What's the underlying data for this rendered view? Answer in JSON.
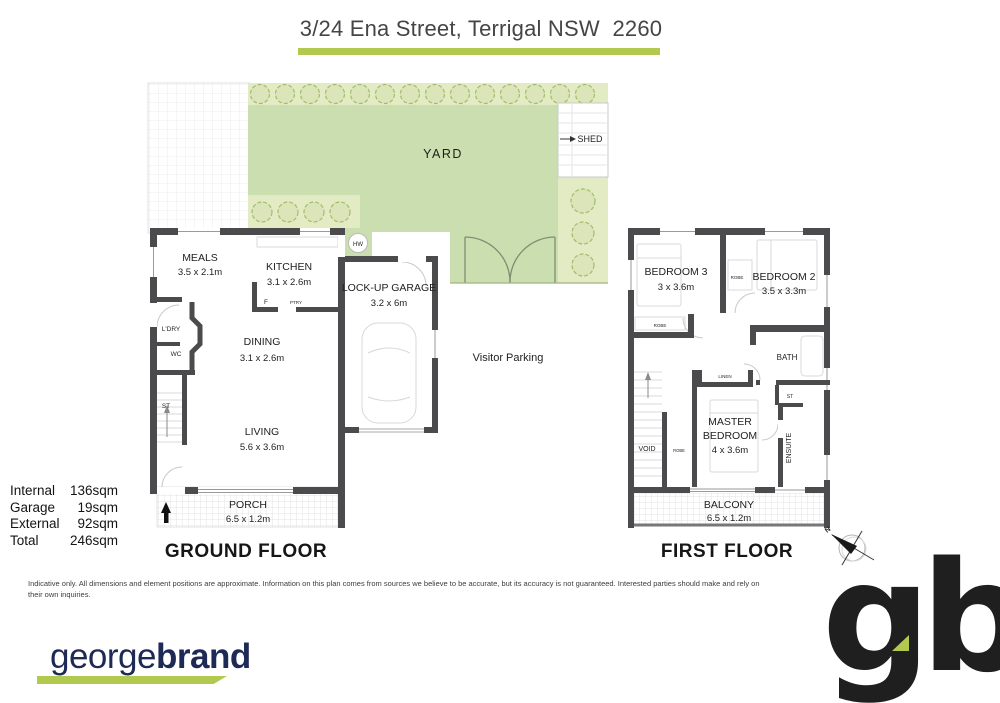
{
  "header": {
    "title": "3/24 Ena Street, Terrigal NSW  2260"
  },
  "yard": {
    "label": "YARD",
    "shed_label": "SHED",
    "hw_label": "HW"
  },
  "visitor_parking": "Visitor Parking",
  "ground": {
    "floor_label": "GROUND FLOOR",
    "meals": {
      "name": "MEALS",
      "dims": "3.5 x 2.1m"
    },
    "kitchen": {
      "name": "KITCHEN",
      "dims": "3.1 x 2.6m"
    },
    "garage": {
      "name": "LOCK-UP GARAGE",
      "dims": "3.2 x 6m"
    },
    "dining": {
      "name": "DINING",
      "dims": "3.1 x 2.6m"
    },
    "living": {
      "name": "LIVING",
      "dims": "5.6 x 3.6m"
    },
    "porch": {
      "name": "PORCH",
      "dims": "6.5 x 1.2m"
    },
    "laundry": "L'DRY",
    "wc": "WC",
    "stair": "ST",
    "fridge": "F",
    "pantry": "PTRY"
  },
  "first": {
    "floor_label": "FIRST FLOOR",
    "bed3": {
      "name": "BEDROOM 3",
      "dims": "3 x 3.6m"
    },
    "bed2": {
      "name": "BEDROOM 2",
      "dims": "3.5 x 3.3m"
    },
    "master": {
      "line1": "MASTER",
      "line2": "BEDROOM",
      "dims": "4 x 3.6m"
    },
    "balcony": {
      "name": "BALCONY",
      "dims": "6.5 x 1.2m"
    },
    "bath": "BATH",
    "ensuite": "ENSUITE",
    "linen": "LINEN",
    "void": "VOID",
    "robe": "ROBE",
    "st": "ST",
    "compass_n": "N"
  },
  "areas": {
    "rows": [
      {
        "label": "Internal",
        "value": "136sqm"
      },
      {
        "label": "Garage",
        "value": "19sqm"
      },
      {
        "label": "External",
        "value": "92sqm"
      },
      {
        "label": "Total",
        "value": "246sqm"
      }
    ]
  },
  "disclaimer": "Indicative only. All dimensions and element positions are approximate. Information on this plan comes from sources we believe to be accurate, but its accuracy is not guaranteed. Interested parties should make and rely on their own inquiries.",
  "brand": {
    "regular": "george",
    "bold": "brand",
    "monogram": "gb"
  },
  "colors": {
    "accent_green": "#b2c94f",
    "yard_green": "#cbdeb0",
    "tree_band": "#e3ebc4",
    "tree_line": "#a2bd68",
    "wall": "#4b4b4d",
    "navy": "#1e2a56"
  }
}
